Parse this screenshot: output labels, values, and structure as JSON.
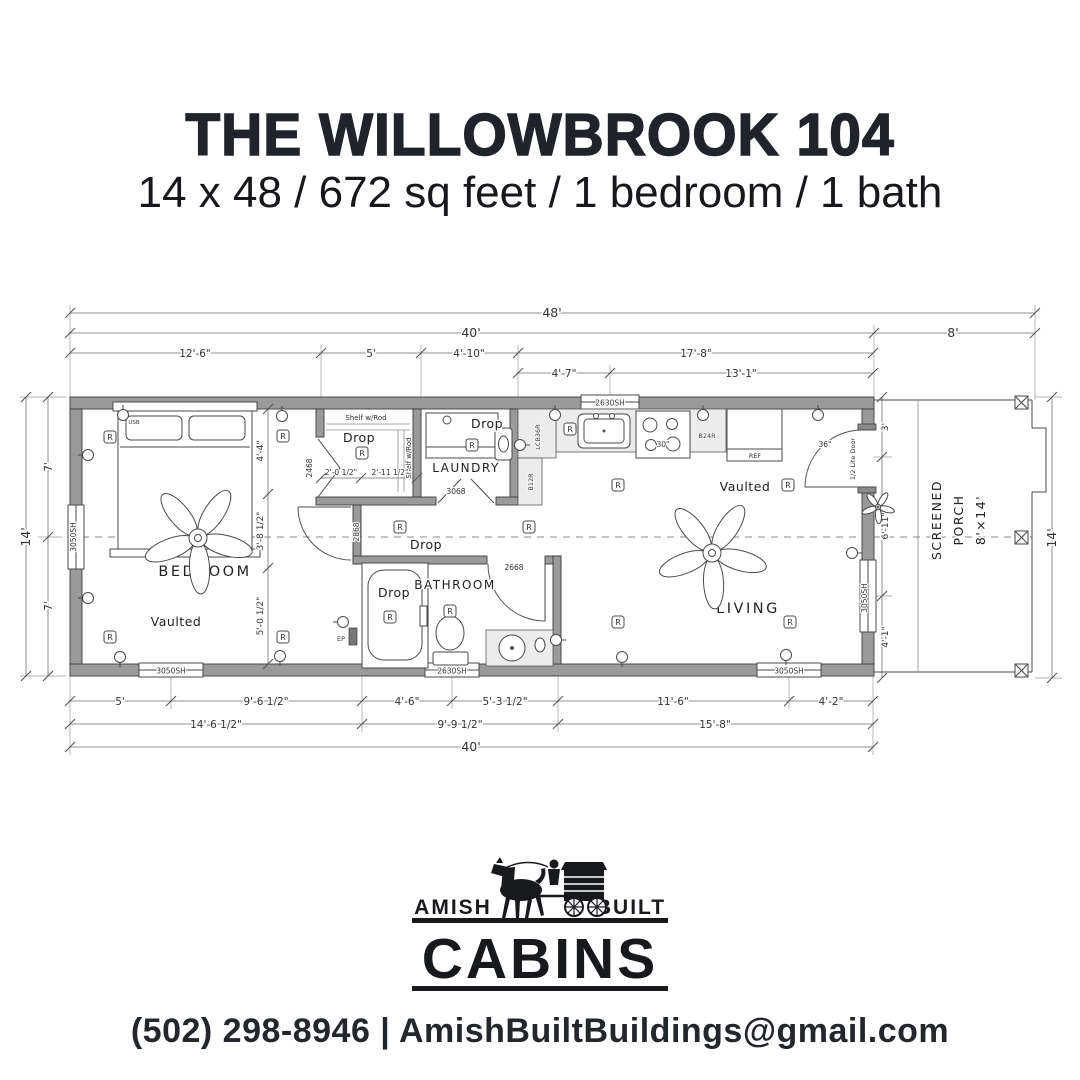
{
  "header": {
    "title": "THE WILLOWBROOK 104",
    "subtitle": "14 x 48 / 672 sq feet / 1 bedroom / 1 bath"
  },
  "plan": {
    "rooms": {
      "bedroom": "BEDROOM",
      "bathroom": "BATHROOM",
      "laundry": "LAUNDRY",
      "living": "LIVING",
      "vaulted": "Vaulted",
      "porch_screened": "SCREENED",
      "porch_name": "PORCH",
      "porch_size": "8'×14'"
    },
    "dims": {
      "overall_width": "48'",
      "main_width_top": "40'",
      "porch_width": "8'",
      "bed_width": "12'-6\"",
      "closet_width": "5'",
      "entry_width": "4'-10\"",
      "kitchen_living": "17'-8\"",
      "kitchen_seg": "4'-7\"",
      "living_seg": "13'-1\"",
      "height_total_left": "14'",
      "height_top_left": "7'",
      "height_bottom_left": "7'",
      "height_total_right": "14'",
      "b_seg1": "5'",
      "b_seg2": "9'-6 1/2\"",
      "b_seg3": "4'-6\"",
      "b_seg4": "5'-3 1/2\"",
      "b_seg5": "11'-6\"",
      "b_seg6": "4'-2\"",
      "b_sub1": "14'-6 1/2\"",
      "b_sub2": "9'-9 1/2\"",
      "b_sub3": "15'-8\"",
      "main_width_bottom": "40'",
      "int_seg1": "4'-4\"",
      "int_seg2": "3'-8 1/2\"",
      "int_seg3": "5'-0 1/2\"",
      "closet_seg1": "2'-0 1/2\"",
      "closet_seg2": "2'-11 1/2\"",
      "porch_seg1": "3'",
      "porch_seg2": "6'-11\"",
      "porch_seg3": "4'-1\""
    },
    "openings": {
      "closet_bifold": "2468",
      "bedroom_door": "2868",
      "bathroom_door": "2668",
      "laundry_door": "3068",
      "front_door_width": "36\"",
      "front_door_type": "1/2 Lite Door",
      "window_3050": "3050SH",
      "window_2630": "2630SH"
    },
    "fixtures": {
      "shelf_rod": "Shelf w/Rod",
      "drop": "Drop",
      "recessed": "R",
      "stove_width": "30\"",
      "cabinet_b24r": "B24R",
      "fridge": "REF",
      "cabinet_lcb36r": "LCB36R",
      "cabinet_b12r": "B12R",
      "usb": "USB",
      "panel": "EP"
    },
    "symbols": {
      "ticks": [
        [
          70,
          313
        ],
        [
          1035,
          313
        ],
        [
          70,
          333
        ],
        [
          874,
          333
        ],
        [
          1035,
          333
        ],
        [
          70,
          353
        ],
        [
          321,
          353
        ],
        [
          421,
          353
        ],
        [
          518,
          353
        ],
        [
          873,
          353
        ],
        [
          518,
          373
        ],
        [
          610,
          373
        ],
        [
          873,
          373
        ],
        [
          70,
          701
        ],
        [
          171,
          701
        ],
        [
          362,
          701
        ],
        [
          452,
          701
        ],
        [
          558,
          701
        ],
        [
          789,
          701
        ],
        [
          873,
          701
        ],
        [
          70,
          724
        ],
        [
          362,
          724
        ],
        [
          558,
          724
        ],
        [
          873,
          724
        ],
        [
          70,
          747
        ],
        [
          873,
          747
        ],
        [
          48,
          397
        ],
        [
          48,
          537
        ],
        [
          48,
          676
        ],
        [
          26,
          397
        ],
        [
          26,
          676
        ],
        [
          1052,
          397
        ],
        [
          1052,
          678
        ],
        [
          882,
          397
        ],
        [
          882,
          457
        ],
        [
          882,
          596
        ],
        [
          882,
          678
        ],
        [
          268,
          409
        ],
        [
          268,
          494
        ],
        [
          268,
          568
        ],
        [
          268,
          664
        ],
        [
          321,
          478
        ],
        [
          361,
          478
        ],
        [
          417,
          478
        ]
      ],
      "outlets": [
        [
          123,
          415,
          "u"
        ],
        [
          282,
          416,
          "u"
        ],
        [
          555,
          415,
          "u"
        ],
        [
          703,
          415,
          "u"
        ],
        [
          818,
          415,
          "u"
        ],
        [
          88,
          455,
          "l"
        ],
        [
          88,
          598,
          "l"
        ],
        [
          120,
          657,
          "d"
        ],
        [
          280,
          656,
          "d"
        ],
        [
          622,
          657,
          "d"
        ],
        [
          786,
          655,
          "d"
        ],
        [
          852,
          553,
          "r"
        ],
        [
          343,
          622,
          "l"
        ],
        [
          520,
          445,
          "r"
        ],
        [
          556,
          640,
          "r"
        ]
      ],
      "recessed": [
        [
          110,
          437
        ],
        [
          283,
          436
        ],
        [
          362,
          453
        ],
        [
          472,
          445
        ],
        [
          570,
          429
        ],
        [
          618,
          485
        ],
        [
          788,
          485
        ],
        [
          110,
          637
        ],
        [
          283,
          637
        ],
        [
          400,
          527
        ],
        [
          529,
          527
        ],
        [
          390,
          617
        ],
        [
          450,
          611
        ],
        [
          618,
          622
        ],
        [
          790,
          622
        ]
      ],
      "fans": [
        [
          198,
          538,
          1
        ],
        [
          712,
          553,
          1
        ],
        [
          878,
          507,
          0.3
        ]
      ]
    }
  },
  "logo": {
    "amish": "AMISH",
    "built": "BUILT",
    "cabins": "CABINS"
  },
  "footer": {
    "contact": "(502) 298-8946 | AmishBuiltBuildings@gmail.com"
  },
  "colors": {
    "ink": "#1c1c1c",
    "wall_gray": "#9a9a9a",
    "counter_gray": "#ececec"
  }
}
